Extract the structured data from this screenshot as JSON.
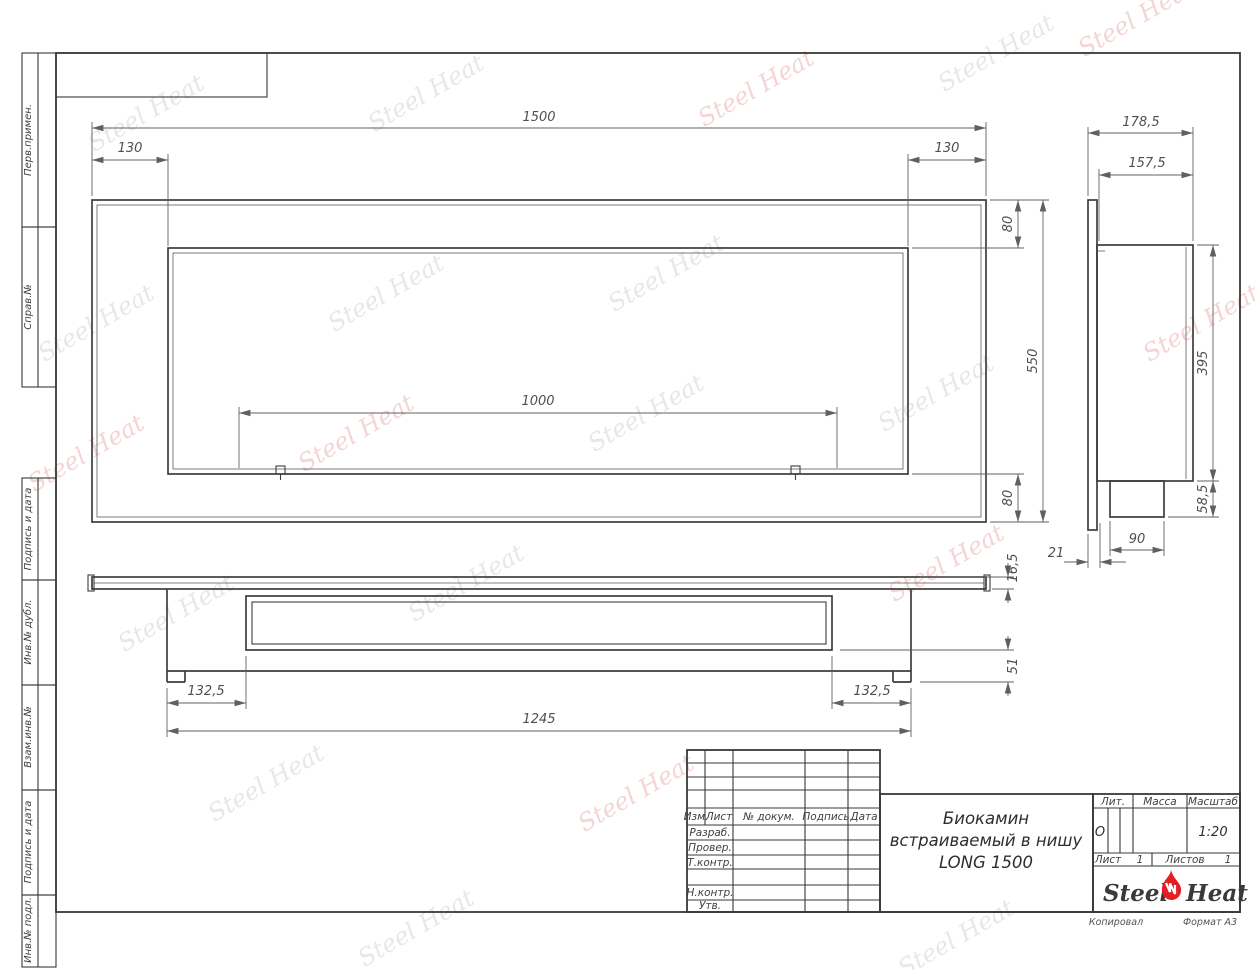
{
  "document": {
    "type": "engineering-drawing",
    "standard": "GOST title block",
    "format": "A3"
  },
  "colors": {
    "line": "#3d3d3d",
    "dimension": "#606060",
    "flame_red": "#e31e24",
    "watermark_gray": "#e0e0e0",
    "watermark_red": "#f0c3c3"
  },
  "watermark": {
    "text": "Steel Heat"
  },
  "dims": {
    "front": {
      "total_width": "1500",
      "offset_left": "130",
      "offset_right": "130",
      "top_border": "80",
      "total_height": "550",
      "bottom_border": "80",
      "burner_length": "1000"
    },
    "side": {
      "depth_total": "178,5",
      "depth_body": "157,5",
      "body_height": "395",
      "burner_drop": "58,5",
      "burner_width": "90",
      "flange_offset": "21"
    },
    "bottom": {
      "flange_thickness": "16,5",
      "foot_height": "51",
      "inset_left": "132,5",
      "inset_right": "132,5",
      "body_width": "1245"
    }
  },
  "sidebar": {
    "items": [
      {
        "label": "Перв.примен."
      },
      {
        "label": "Справ.№"
      },
      {
        "label": "Подпись и дата"
      },
      {
        "label": "Инв.№ дубл."
      },
      {
        "label": "Взам.инв.№"
      },
      {
        "label": "Подпись и дата"
      },
      {
        "label": "Инв.№ подл."
      }
    ]
  },
  "title_block": {
    "title_line1": "Биокамин",
    "title_line2": "встраиваемый в нишу",
    "title_line3": "LONG 1500",
    "columns": {
      "izm": "Изм.",
      "list": "Лист",
      "doc": "№ докум.",
      "sign": "Подпись",
      "date": "Дата"
    },
    "rows": {
      "razrab": "Разраб.",
      "prover": "Провер.",
      "tkontr": "Т.контр.",
      "nkontr": "Н.контр.",
      "utv": "Утв."
    },
    "lit_label": "Лит.",
    "lit_value": "О",
    "mass_label": "Масса",
    "scale_label": "Масштаб",
    "scale_value": "1:20",
    "sheet_label": "Лист",
    "sheet_value": "1",
    "sheets_label": "Листов",
    "sheets_value": "1"
  },
  "logo": {
    "part1": "Steel",
    "part2": "Heat"
  },
  "footer": {
    "copied": "Копировал",
    "format": "Формат А3"
  }
}
